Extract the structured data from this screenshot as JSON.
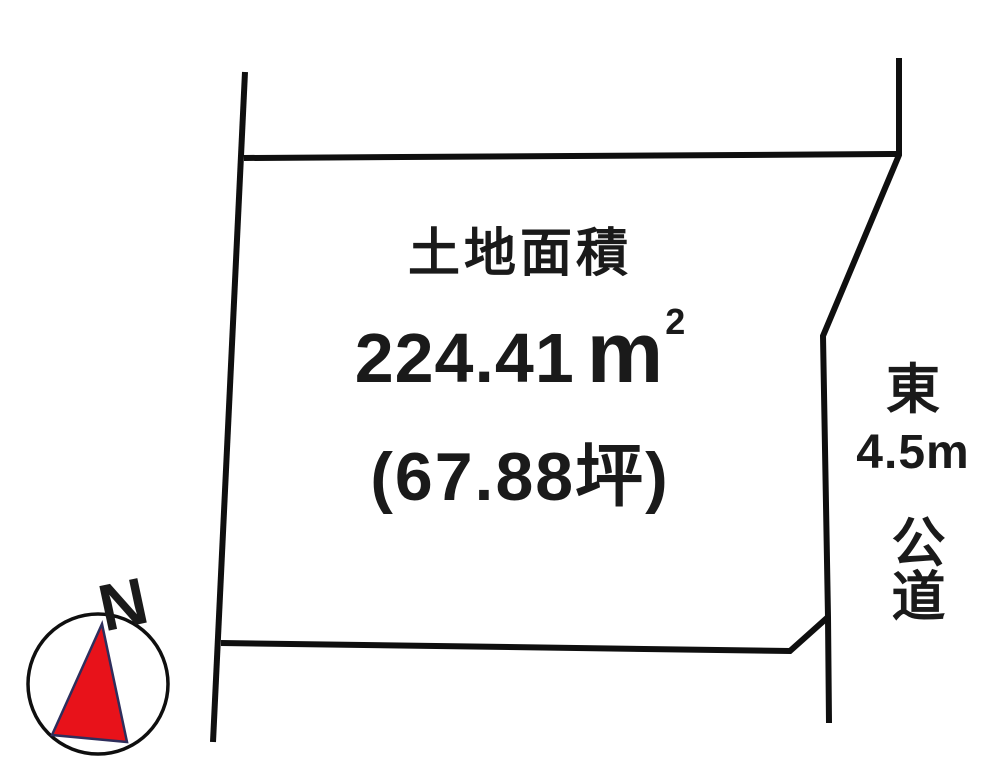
{
  "colors": {
    "line": "#0f0f0f",
    "text": "#1a1a1a",
    "north_red": "#e8121a",
    "triangle_outline": "#2e2e5c"
  },
  "parcel": {
    "title": "土地面積",
    "area_sqm": {
      "value": "224.41",
      "unit": "m",
      "exponent": "2"
    },
    "area_tsubo": "(67.88坪)"
  },
  "road": {
    "direction": "東",
    "width": "4.5m",
    "type": "公道"
  },
  "compass": {
    "north": "N"
  }
}
